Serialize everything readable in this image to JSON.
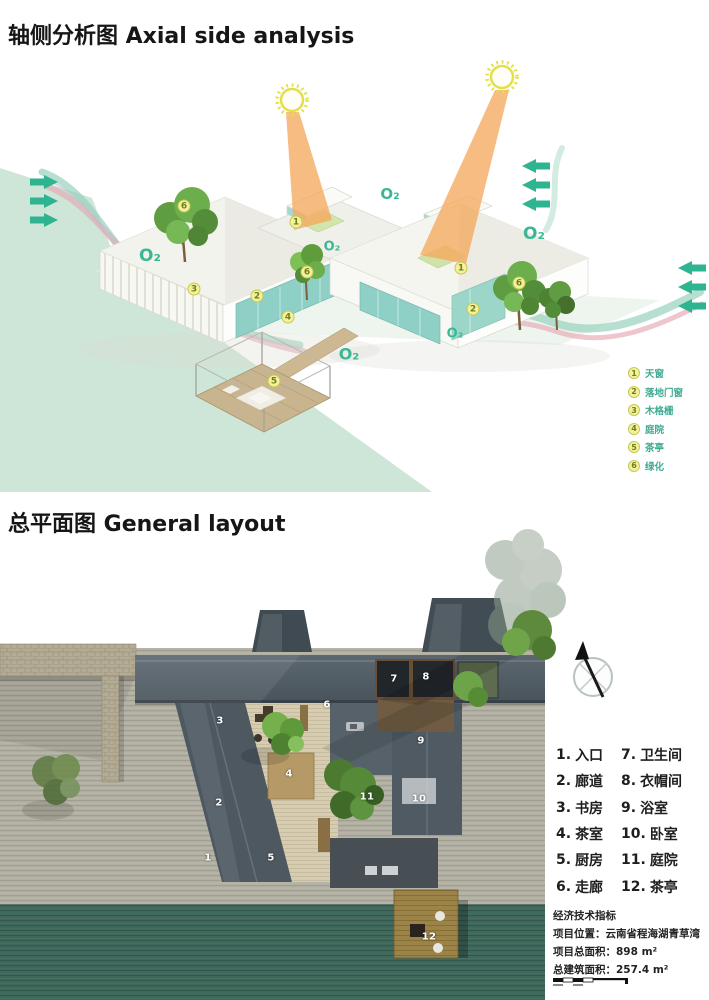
{
  "axial": {
    "title": "轴侧分析图 Axial side analysis",
    "o2_text": "O₂",
    "o2_labels": [
      {
        "x": 150,
        "y": 256,
        "s": 17
      },
      {
        "x": 390,
        "y": 194,
        "s": 15
      },
      {
        "x": 534,
        "y": 234,
        "s": 17
      },
      {
        "x": 332,
        "y": 247,
        "s": 13
      },
      {
        "x": 349,
        "y": 354,
        "s": 16
      },
      {
        "x": 455,
        "y": 334,
        "s": 13
      }
    ],
    "markers": [
      {
        "n": "1",
        "x": 296,
        "y": 222
      },
      {
        "n": "1",
        "x": 461,
        "y": 268
      },
      {
        "n": "2",
        "x": 257,
        "y": 296
      },
      {
        "n": "2",
        "x": 473,
        "y": 309
      },
      {
        "n": "3",
        "x": 194,
        "y": 289
      },
      {
        "n": "4",
        "x": 288,
        "y": 317
      },
      {
        "n": "5",
        "x": 274,
        "y": 381
      },
      {
        "n": "6",
        "x": 184,
        "y": 206
      },
      {
        "n": "6",
        "x": 307,
        "y": 272
      },
      {
        "n": "6",
        "x": 519,
        "y": 283
      }
    ],
    "legend": [
      {
        "num": "1",
        "label": "天窗"
      },
      {
        "num": "2",
        "label": "落地门窗"
      },
      {
        "num": "3",
        "label": "木格栅"
      },
      {
        "num": "4",
        "label": "庭院"
      },
      {
        "num": "5",
        "label": "茶亭"
      },
      {
        "num": "6",
        "label": "绿化"
      }
    ]
  },
  "plan": {
    "title": "总平面图 General layout",
    "room_numbers": [
      {
        "n": "1",
        "x": 208,
        "y": 858
      },
      {
        "n": "2",
        "x": 219,
        "y": 803
      },
      {
        "n": "3",
        "x": 220,
        "y": 721
      },
      {
        "n": "4",
        "x": 289,
        "y": 774
      },
      {
        "n": "5",
        "x": 271,
        "y": 858
      },
      {
        "n": "6",
        "x": 327,
        "y": 705
      },
      {
        "n": "7",
        "x": 394,
        "y": 679
      },
      {
        "n": "8",
        "x": 426,
        "y": 677
      },
      {
        "n": "9",
        "x": 421,
        "y": 741
      },
      {
        "n": "10",
        "x": 419,
        "y": 799
      },
      {
        "n": "11",
        "x": 367,
        "y": 797
      },
      {
        "n": "12",
        "x": 429,
        "y": 937
      }
    ],
    "legend_left": [
      {
        "num": "1.",
        "label": "入口"
      },
      {
        "num": "2.",
        "label": "廊道"
      },
      {
        "num": "3.",
        "label": "书房"
      },
      {
        "num": "4.",
        "label": "茶室"
      },
      {
        "num": "5.",
        "label": "厨房"
      },
      {
        "num": "6.",
        "label": "走廊"
      }
    ],
    "legend_right": [
      {
        "num": "7.",
        "label": "卫生间"
      },
      {
        "num": "8.",
        "label": "衣帽间"
      },
      {
        "num": "9.",
        "label": "浴室"
      },
      {
        "num": "10.",
        "label": "卧室"
      },
      {
        "num": "11.",
        "label": "庭院"
      },
      {
        "num": "12.",
        "label": "茶亭"
      }
    ],
    "info": {
      "heading": "经济技术指标",
      "lines": [
        "项目位置：云南省程海湖青草湾",
        "项目总面积：898 m²",
        "总建筑面积：257.4 m²"
      ]
    }
  },
  "colors": {
    "accent_teal": "#3cb795",
    "marker_yellow": "#f3f0a0",
    "sun_yellow": "#e3df4a",
    "beam_orange": "#f4a95e",
    "terrain_mint": "#cde6d7",
    "water_dark": "#3f685c"
  }
}
